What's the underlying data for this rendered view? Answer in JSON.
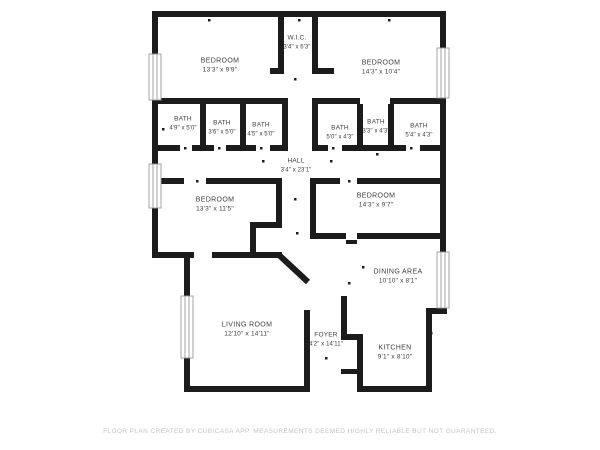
{
  "rooms": {
    "wic": {
      "name": "W.I.C.",
      "dims": "3'4\" x 6'3\""
    },
    "bedroom_top_left": {
      "name": "BEDROOM",
      "dims": "13'3\" x 9'9\""
    },
    "bedroom_top_right": {
      "name": "BEDROOM",
      "dims": "14'3\" x 10'4\""
    },
    "bath_1": {
      "name": "BATH",
      "dims": "4'9\" x 5'0\""
    },
    "bath_2": {
      "name": "BATH",
      "dims": "3'6\" x 5'0\""
    },
    "bath_3": {
      "name": "BATH",
      "dims": "4'5\" x 5'0\""
    },
    "bath_4": {
      "name": "BATH",
      "dims": "5'0\" x 4'3\""
    },
    "bath_5": {
      "name": "BATH",
      "dims": "3'3\" x 4'3\""
    },
    "bath_6": {
      "name": "BATH",
      "dims": "5'4\" x 4'3\""
    },
    "hall": {
      "name": "HALL",
      "dims": "3'4\" x 23'1\""
    },
    "bedroom_mid_left": {
      "name": "BEDROOM",
      "dims": "13'3\" x 11'5\""
    },
    "bedroom_mid_right": {
      "name": "BEDROOM",
      "dims": "14'3\" x 9'7\""
    },
    "dining_area": {
      "name": "DINING AREA",
      "dims": "10'10\" x 8'1\""
    },
    "living_room": {
      "name": "LIVING ROOM",
      "dims": "12'10\" x 14'11\""
    },
    "foyer": {
      "name": "FOYER",
      "dims": "4'2\" x 14'11\""
    },
    "kitchen": {
      "name": "KITCHEN",
      "dims": "9'1\" x 8'10\""
    }
  },
  "footer": {
    "disclaimer": "FLOOR PLAN CREATED BY CUBICASA APP. MEASUREMENTS DEEMED HIGHLY RELIABLE BUT NOT GUARANTEED."
  },
  "colors": {
    "wall": "#1c1c1c",
    "room_label": "#3d3d3d",
    "disclaimer_text": "#c4c4c4",
    "background": "#ffffff"
  }
}
